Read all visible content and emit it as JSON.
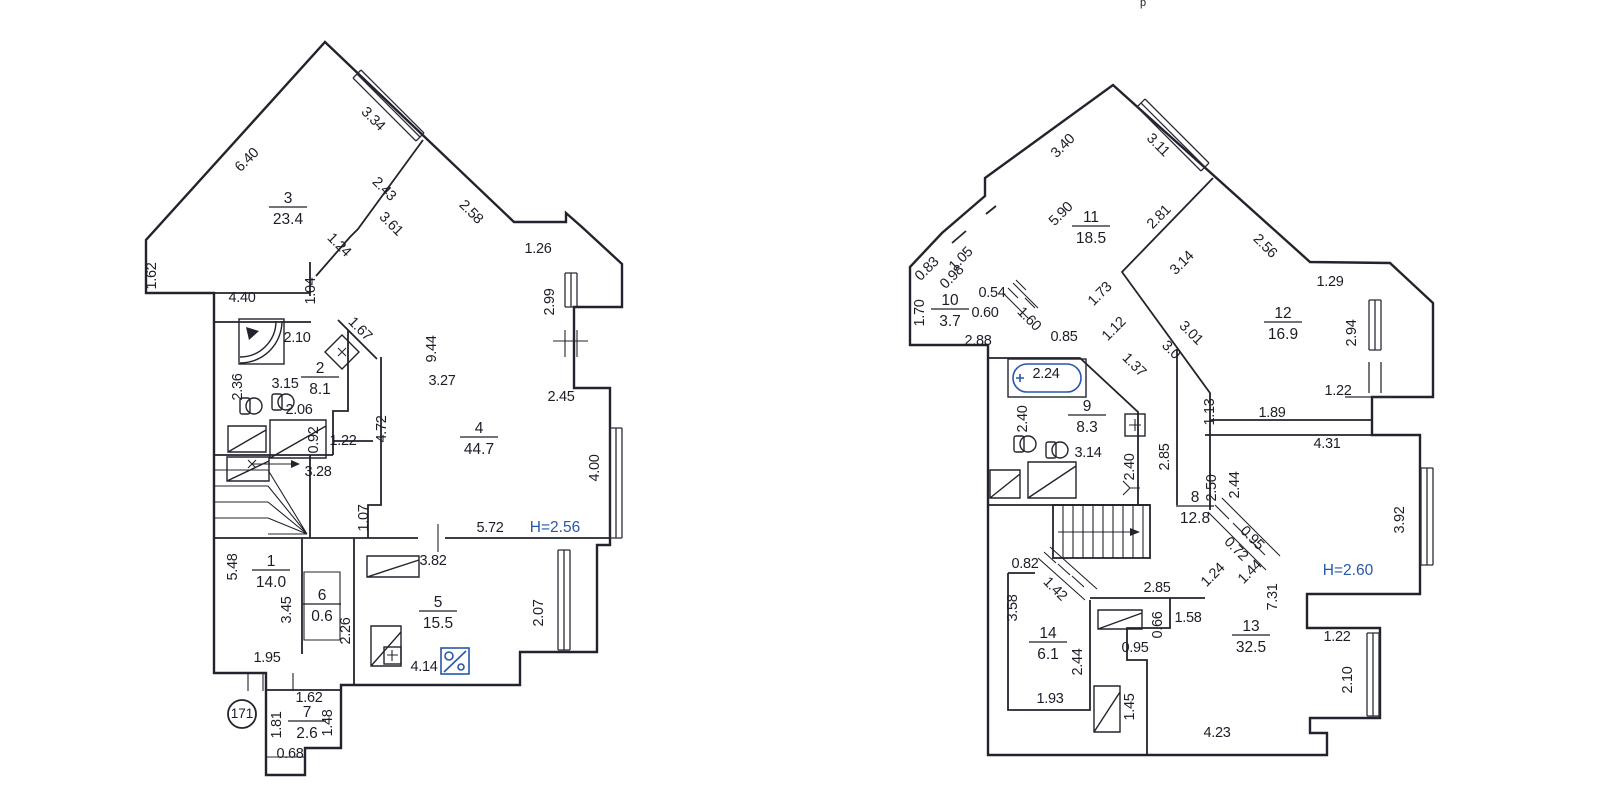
{
  "document": {
    "kind": "scanned floor plan drawing, two levels of a duplex apartment",
    "ink_color": "#23232e",
    "accent_blue": "#2757ab",
    "paper_color": "#ffffff",
    "artifact_text": "p"
  },
  "plans": [
    {
      "id": "left",
      "label_group": "labels-left",
      "height_note": {
        "text": "H=2.56",
        "x": 555,
        "y": 527
      },
      "unit_number": {
        "text": "171",
        "x": 242,
        "y": 714
      },
      "rooms": [
        {
          "number": "3",
          "area": "23.4",
          "x": 288,
          "y": 207
        },
        {
          "number": "2",
          "area": "8.1",
          "x": 320,
          "y": 377
        },
        {
          "number": "4",
          "area": "44.7",
          "x": 479,
          "y": 437
        },
        {
          "number": "1",
          "area": "14.0",
          "x": 271,
          "y": 570
        },
        {
          "number": "6",
          "area": "0.6",
          "x": 322,
          "y": 604
        },
        {
          "number": "5",
          "area": "15.5",
          "x": 438,
          "y": 611
        },
        {
          "number": "7",
          "area": "2.6",
          "x": 307,
          "y": 721
        }
      ],
      "dims": [
        {
          "t": "6.40",
          "x": 250,
          "y": 158,
          "r": -45
        },
        {
          "t": "3.34",
          "x": 370,
          "y": 117,
          "r": 45
        },
        {
          "t": "2.43",
          "x": 381,
          "y": 187,
          "r": 45
        },
        {
          "t": "2.58",
          "x": 468,
          "y": 210,
          "r": 45
        },
        {
          "t": "3.61",
          "x": 388,
          "y": 222,
          "r": 45
        },
        {
          "t": "1.24",
          "x": 336,
          "y": 243,
          "r": 45
        },
        {
          "t": "1.67",
          "x": 357,
          "y": 327,
          "r": 45
        },
        {
          "t": "1.62",
          "x": 156,
          "y": 271,
          "r": 90
        },
        {
          "t": "4.40",
          "x": 242,
          "y": 297,
          "r": 0
        },
        {
          "t": "1.04",
          "x": 315,
          "y": 286,
          "r": 90
        },
        {
          "t": "1.26",
          "x": 538,
          "y": 248,
          "r": 0
        },
        {
          "t": "2.99",
          "x": 554,
          "y": 297,
          "r": 90
        },
        {
          "t": "2.10",
          "x": 297,
          "y": 337,
          "r": 0
        },
        {
          "t": "2.36",
          "x": 242,
          "y": 382,
          "r": 90
        },
        {
          "t": "3.15",
          "x": 285,
          "y": 383,
          "r": 0
        },
        {
          "t": "2.06",
          "x": 299,
          "y": 409,
          "r": 0
        },
        {
          "t": "0.92",
          "x": 318,
          "y": 435,
          "r": 90
        },
        {
          "t": "1.22",
          "x": 343,
          "y": 440,
          "r": 0
        },
        {
          "t": "3.28",
          "x": 318,
          "y": 471,
          "r": 0
        },
        {
          "t": "4.72",
          "x": 386,
          "y": 424,
          "r": 90
        },
        {
          "t": "9.44",
          "x": 436,
          "y": 344,
          "r": 90
        },
        {
          "t": "3.27",
          "x": 442,
          "y": 380,
          "r": 0
        },
        {
          "t": "2.45",
          "x": 561,
          "y": 396,
          "r": 0
        },
        {
          "t": "4.00",
          "x": 599,
          "y": 463,
          "r": 90
        },
        {
          "t": "1.07",
          "x": 368,
          "y": 513,
          "r": 90
        },
        {
          "t": "5.72",
          "x": 490,
          "y": 527,
          "r": 0
        },
        {
          "t": "3.82",
          "x": 433,
          "y": 560,
          "r": 0
        },
        {
          "t": "5.48",
          "x": 237,
          "y": 562,
          "r": 90
        },
        {
          "t": "3.45",
          "x": 291,
          "y": 605,
          "r": 90
        },
        {
          "t": "2.26",
          "x": 350,
          "y": 626,
          "r": 90
        },
        {
          "t": "2.07",
          "x": 543,
          "y": 608,
          "r": 90
        },
        {
          "t": "1.95",
          "x": 267,
          "y": 657,
          "r": 0
        },
        {
          "t": "4.14",
          "x": 424,
          "y": 666,
          "r": 0
        },
        {
          "t": "1.62",
          "x": 309,
          "y": 697,
          "r": 0
        },
        {
          "t": "1.81",
          "x": 281,
          "y": 720,
          "r": 90
        },
        {
          "t": "1.48",
          "x": 332,
          "y": 718,
          "r": 90
        },
        {
          "t": "0.68",
          "x": 290,
          "y": 753,
          "r": 0
        }
      ]
    },
    {
      "id": "right",
      "label_group": "labels-right",
      "height_note": {
        "text": "H=2.60",
        "x": 1348,
        "y": 570
      },
      "unit_number": null,
      "rooms": [
        {
          "number": "11",
          "area": "18.5",
          "x": 1091,
          "y": 226
        },
        {
          "number": "10",
          "area": "3.7",
          "x": 950,
          "y": 309
        },
        {
          "number": "12",
          "area": "16.9",
          "x": 1283,
          "y": 322
        },
        {
          "number": "9",
          "area": "8.3",
          "x": 1087,
          "y": 415
        },
        {
          "number": "8",
          "area": "12.8",
          "x": 1195,
          "y": 506
        },
        {
          "number": "13",
          "area": "32.5",
          "x": 1251,
          "y": 635
        },
        {
          "number": "14",
          "area": "6.1",
          "x": 1048,
          "y": 642
        }
      ],
      "dims": [
        {
          "t": "3.40",
          "x": 1066,
          "y": 144,
          "r": -45
        },
        {
          "t": "3.11",
          "x": 1155,
          "y": 143,
          "r": 45
        },
        {
          "t": "5.90",
          "x": 1064,
          "y": 212,
          "r": -45
        },
        {
          "t": "2.81",
          "x": 1162,
          "y": 215,
          "r": -45
        },
        {
          "t": "2.56",
          "x": 1262,
          "y": 244,
          "r": 45
        },
        {
          "t": "3.14",
          "x": 1185,
          "y": 261,
          "r": -45
        },
        {
          "t": "1.05",
          "x": 964,
          "y": 257,
          "r": -45
        },
        {
          "t": "0.83",
          "x": 930,
          "y": 267,
          "r": -45
        },
        {
          "t": "0.98",
          "x": 955,
          "y": 275,
          "r": -45
        },
        {
          "t": "1.70",
          "x": 924,
          "y": 308,
          "r": 90
        },
        {
          "t": "0.54",
          "x": 992,
          "y": 292,
          "r": 0
        },
        {
          "t": "0.60",
          "x": 985,
          "y": 312,
          "r": 0
        },
        {
          "t": "2.88",
          "x": 978,
          "y": 340,
          "r": 0
        },
        {
          "t": "1.60",
          "x": 1026,
          "y": 317,
          "r": 45
        },
        {
          "t": "0.85",
          "x": 1064,
          "y": 336,
          "r": 0
        },
        {
          "t": "1.73",
          "x": 1103,
          "y": 292,
          "r": -45
        },
        {
          "t": "1.12",
          "x": 1117,
          "y": 327,
          "r": -45
        },
        {
          "t": "1.37",
          "x": 1131,
          "y": 363,
          "r": 45
        },
        {
          "t": "3.01",
          "x": 1188,
          "y": 331,
          "r": 45
        },
        {
          "t": "3.0",
          "x": 1168,
          "y": 348,
          "r": 45
        },
        {
          "t": "1.29",
          "x": 1330,
          "y": 281,
          "r": 0
        },
        {
          "t": "2.94",
          "x": 1356,
          "y": 328,
          "r": 90
        },
        {
          "t": "1.22",
          "x": 1338,
          "y": 390,
          "r": 0
        },
        {
          "t": "1.89",
          "x": 1272,
          "y": 412,
          "r": 0
        },
        {
          "t": "1.13",
          "x": 1214,
          "y": 407,
          "r": 90
        },
        {
          "t": "4.31",
          "x": 1327,
          "y": 443,
          "r": 0
        },
        {
          "t": "2.24",
          "x": 1046,
          "y": 373,
          "r": 0
        },
        {
          "t": "2.40",
          "x": 1027,
          "y": 414,
          "r": 90
        },
        {
          "t": "3.14",
          "x": 1088,
          "y": 452,
          "r": 0
        },
        {
          "t": "2.40",
          "x": 1134,
          "y": 462,
          "r": 90
        },
        {
          "t": "2.85",
          "x": 1169,
          "y": 452,
          "r": 90
        },
        {
          "t": "2.50",
          "x": 1216,
          "y": 483,
          "r": 90
        },
        {
          "t": "2.44",
          "x": 1239,
          "y": 480,
          "r": 90
        },
        {
          "t": "0.95",
          "x": 1249,
          "y": 536,
          "r": 45
        },
        {
          "t": "0.72",
          "x": 1233,
          "y": 547,
          "r": 45
        },
        {
          "t": "1.24",
          "x": 1216,
          "y": 573,
          "r": -45
        },
        {
          "t": "1.44",
          "x": 1253,
          "y": 570,
          "r": -45
        },
        {
          "t": "7.31",
          "x": 1277,
          "y": 592,
          "r": 90
        },
        {
          "t": "3.92",
          "x": 1404,
          "y": 515,
          "r": 90
        },
        {
          "t": "0.82",
          "x": 1025,
          "y": 563,
          "r": 0
        },
        {
          "t": "1.42",
          "x": 1052,
          "y": 587,
          "r": 45
        },
        {
          "t": "3.58",
          "x": 1017,
          "y": 603,
          "r": 90
        },
        {
          "t": "2.85",
          "x": 1157,
          "y": 587,
          "r": 0
        },
        {
          "t": "1.58",
          "x": 1188,
          "y": 617,
          "r": 0
        },
        {
          "t": "0.66",
          "x": 1162,
          "y": 620,
          "r": 90
        },
        {
          "t": "0.95",
          "x": 1135,
          "y": 647,
          "r": 0
        },
        {
          "t": "2.44",
          "x": 1082,
          "y": 657,
          "r": 90
        },
        {
          "t": "1.93",
          "x": 1050,
          "y": 698,
          "r": 0
        },
        {
          "t": "1.45",
          "x": 1134,
          "y": 702,
          "r": 90
        },
        {
          "t": "4.23",
          "x": 1217,
          "y": 732,
          "r": 0
        },
        {
          "t": "1.22",
          "x": 1337,
          "y": 636,
          "r": 0
        },
        {
          "t": "2.10",
          "x": 1352,
          "y": 675,
          "r": 90
        }
      ]
    }
  ]
}
